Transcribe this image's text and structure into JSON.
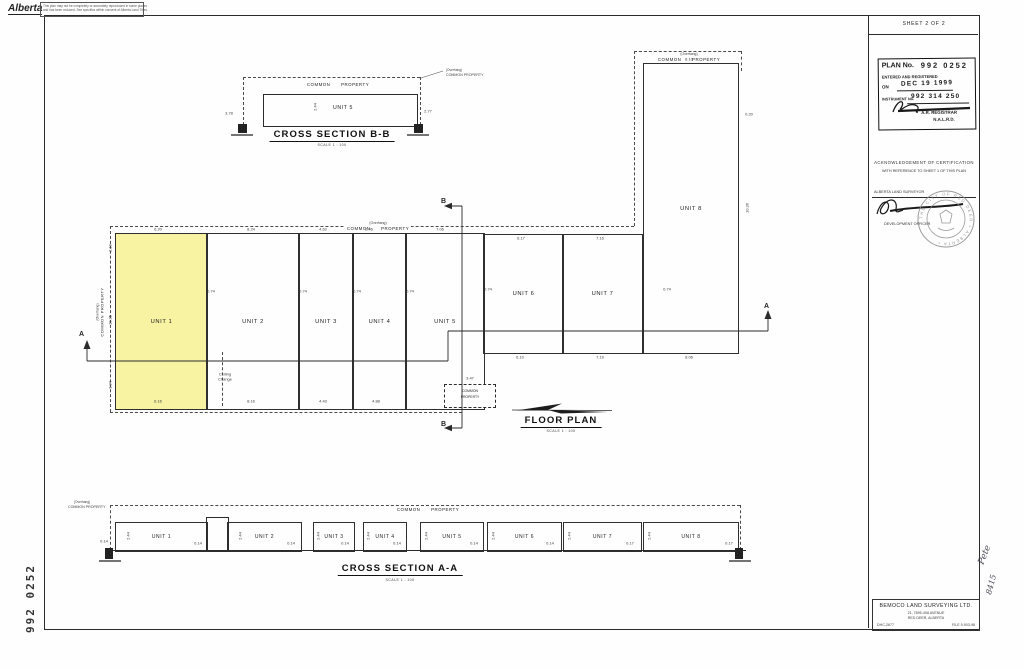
{
  "header": {
    "logo_text": "Alberta",
    "disclaimer_line1": "This plan may not be completely or accurately reproduced in some places",
    "disclaimer_line2": "and has been reduced. See specifics within consent of Alberta Land Titles."
  },
  "titleblock": {
    "sheet_label": "SHEET 2 OF 2",
    "stamp": {
      "plan_no_label": "PLAN No.",
      "plan_no_value": "992 0252",
      "entered_label": "ENTERED AND REGISTERED",
      "on_label": "ON",
      "date_value": "DEC 19 1999",
      "instrument_label": "INSTRUMENT No.",
      "instrument_value": "992 314 250",
      "registrar_line1": "A.R. REGISTRAR",
      "registrar_line2": "N.A.L.R.D."
    },
    "certification": {
      "line1": "ACKNOWLEDGEMENT OF CERTIFICATION",
      "line2": "WITH REFERENCE TO SHEET 1 OF THIS PLAN",
      "surveyor_label": "ALBERTA LAND SURVEYOR",
      "officer_label": "DEVELOPMENT OFFICER",
      "seal_text": "THE CITY OF RED DEER • ALBERTA •"
    },
    "company": {
      "name": "BEMOCO LAND SURVEYING LTD.",
      "address_line1": "21, 7895-49A AVENUE",
      "address_line2": "RED DEER, ALBERTA",
      "ref_left": "DHC-2677",
      "ref_right": "FILE 9-903-98"
    }
  },
  "margins": {
    "plan_number_vertical": "992 0252",
    "handwritten_note1": "Pete",
    "handwritten_note2": "8415"
  },
  "cross_section_bb": {
    "title": "CROSS SECTION B-B",
    "scale": "SCALE 1 : 100",
    "common_property": "COMMON PROPERTY",
    "unit_label": "UNIT 5",
    "overhang_note_line1": "(Overhang)",
    "overhang_note_line2": "COMMON PROPERTY",
    "dims": [
      {
        "t": "3.78",
        "x": 229,
        "y": 113
      },
      {
        "t": "2.77",
        "x": 428,
        "y": 111
      },
      {
        "t": "2.44",
        "x": 315,
        "y": 107,
        "r": -90
      }
    ]
  },
  "floor_plan": {
    "title": "FLOOR PLAN",
    "scale": "SCALE 1 : 100",
    "section_a": "A",
    "section_b": "B",
    "overhang_top_line1": "(Overhang)",
    "overhang_top_line2": "COMMON PROPERTY",
    "overhang_unit8_line1": "(Overhang)",
    "overhang_unit8_line2": "COMMON PROPERTY",
    "overhang_left_line1": "(Overhang)",
    "overhang_left_line2": "COMMON PROPERTY",
    "common_box_line1": "COMMON",
    "common_box_line2": "PROPERTY",
    "units": [
      {
        "id": 1,
        "label": "UNIT 1",
        "x": 115,
        "y": 233,
        "w": 91,
        "h": 175,
        "highlight": true
      },
      {
        "id": 2,
        "label": "UNIT 2",
        "x": 206,
        "y": 233,
        "w": 92,
        "h": 175,
        "highlight": false
      },
      {
        "id": 3,
        "label": "UNIT 3",
        "x": 298,
        "y": 233,
        "w": 54,
        "h": 175,
        "highlight": false
      },
      {
        "id": 4,
        "label": "UNIT 4",
        "x": 352,
        "y": 233,
        "w": 53,
        "h": 175,
        "highlight": false
      },
      {
        "id": 5,
        "label": "UNIT 5",
        "x": 405,
        "y": 233,
        "w": 78,
        "h": 175,
        "highlight": false
      },
      {
        "id": 6,
        "label": "UNIT 6",
        "x": 483,
        "y": 234,
        "w": 79,
        "h": 118,
        "highlight": false
      },
      {
        "id": 7,
        "label": "UNIT 7",
        "x": 562,
        "y": 234,
        "w": 79,
        "h": 118,
        "highlight": false
      },
      {
        "id": 8,
        "label": "UNIT 8",
        "x": 643,
        "y": 63,
        "w": 94,
        "h": 289,
        "highlight": false
      }
    ],
    "dims": [
      {
        "t": "6.20",
        "x": 158,
        "y": 229
      },
      {
        "t": "8.24",
        "x": 251,
        "y": 229
      },
      {
        "t": "4.62",
        "x": 323,
        "y": 229
      },
      {
        "t": "2.46",
        "x": 369,
        "y": 229
      },
      {
        "t": "7.06",
        "x": 440,
        "y": 229
      },
      {
        "t": "6.17",
        "x": 521,
        "y": 238
      },
      {
        "t": "7.16",
        "x": 600,
        "y": 238
      },
      {
        "t": "8.10",
        "x": 689,
        "y": 59
      },
      {
        "t": "0.20",
        "x": 749,
        "y": 114
      },
      {
        "t": "10.36",
        "x": 747,
        "y": 208,
        "r": -90
      },
      {
        "t": "6.16",
        "x": 158,
        "y": 401
      },
      {
        "t": "8.16",
        "x": 251,
        "y": 401
      },
      {
        "t": "4.43",
        "x": 323,
        "y": 401
      },
      {
        "t": "4.88",
        "x": 376,
        "y": 401
      },
      {
        "t": "6.10",
        "x": 520,
        "y": 357
      },
      {
        "t": "7.19",
        "x": 600,
        "y": 357
      },
      {
        "t": "8.06",
        "x": 689,
        "y": 357
      },
      {
        "t": "0.74",
        "x": 211,
        "y": 291
      },
      {
        "t": "0.74",
        "x": 303,
        "y": 291
      },
      {
        "t": "0.74",
        "x": 357,
        "y": 291
      },
      {
        "t": "0.74",
        "x": 410,
        "y": 291
      },
      {
        "t": "0.74",
        "x": 488,
        "y": 289
      },
      {
        "t": "0.74",
        "x": 667,
        "y": 289
      },
      {
        "t": "2.19",
        "x": 110,
        "y": 248,
        "r": -90
      },
      {
        "t": "10.35",
        "x": 110,
        "y": 320,
        "r": -90
      },
      {
        "t": "3.04",
        "x": 110,
        "y": 385,
        "r": -90
      },
      {
        "t": "3.47",
        "x": 470,
        "y": 378
      },
      {
        "t": "Ceiling",
        "x": 225,
        "y": 374
      },
      {
        "t": "Change",
        "x": 225,
        "y": 379
      }
    ]
  },
  "cross_section_aa": {
    "title": "CROSS SECTION A-A",
    "scale": "SCALE 1 : 100",
    "common_property": "COMMON PROPERTY",
    "overhang_line1": "(Overhang)",
    "overhang_line2": "COMMON PROPERTY",
    "box_y": 522,
    "box_h": 28,
    "units": [
      {
        "id": 1,
        "label": "UNIT 1",
        "x": 115,
        "w": 91
      },
      {
        "id": 2,
        "label": "UNIT 2",
        "x": 227,
        "w": 73
      },
      {
        "id": 3,
        "label": "UNIT 3",
        "x": 313,
        "w": 40
      },
      {
        "id": 4,
        "label": "UNIT 4",
        "x": 363,
        "w": 42
      },
      {
        "id": 5,
        "label": "UNIT 5",
        "x": 420,
        "w": 62
      },
      {
        "id": 6,
        "label": "UNIT 6",
        "x": 487,
        "w": 73
      },
      {
        "id": 7,
        "label": "UNIT 7",
        "x": 563,
        "w": 77
      },
      {
        "id": 8,
        "label": "UNIT 8",
        "x": 643,
        "w": 94
      }
    ],
    "dims": [
      {
        "t": "0.14",
        "x": 104,
        "y": 541
      },
      {
        "t": "2.44",
        "x": 128,
        "y": 536,
        "r": -90
      },
      {
        "t": "0.14",
        "x": 198,
        "y": 543
      },
      {
        "t": "2.44",
        "x": 240,
        "y": 536,
        "r": -90
      },
      {
        "t": "0.14",
        "x": 291,
        "y": 543
      },
      {
        "t": "2.44",
        "x": 318,
        "y": 536,
        "r": -90
      },
      {
        "t": "0.14",
        "x": 345,
        "y": 543
      },
      {
        "t": "2.44",
        "x": 368,
        "y": 536,
        "r": -90
      },
      {
        "t": "0.14",
        "x": 397,
        "y": 543
      },
      {
        "t": "2.44",
        "x": 426,
        "y": 536,
        "r": -90
      },
      {
        "t": "0.14",
        "x": 474,
        "y": 543
      },
      {
        "t": "2.44",
        "x": 493,
        "y": 536,
        "r": -90
      },
      {
        "t": "0.14",
        "x": 550,
        "y": 543
      },
      {
        "t": "2.44",
        "x": 569,
        "y": 536,
        "r": -90
      },
      {
        "t": "0.17",
        "x": 630,
        "y": 543
      },
      {
        "t": "2.44",
        "x": 649,
        "y": 536,
        "r": -90
      },
      {
        "t": "0.17",
        "x": 729,
        "y": 543
      }
    ]
  },
  "colors": {
    "highlight": "#f7f3a2",
    "line": "#2b2b2b"
  }
}
